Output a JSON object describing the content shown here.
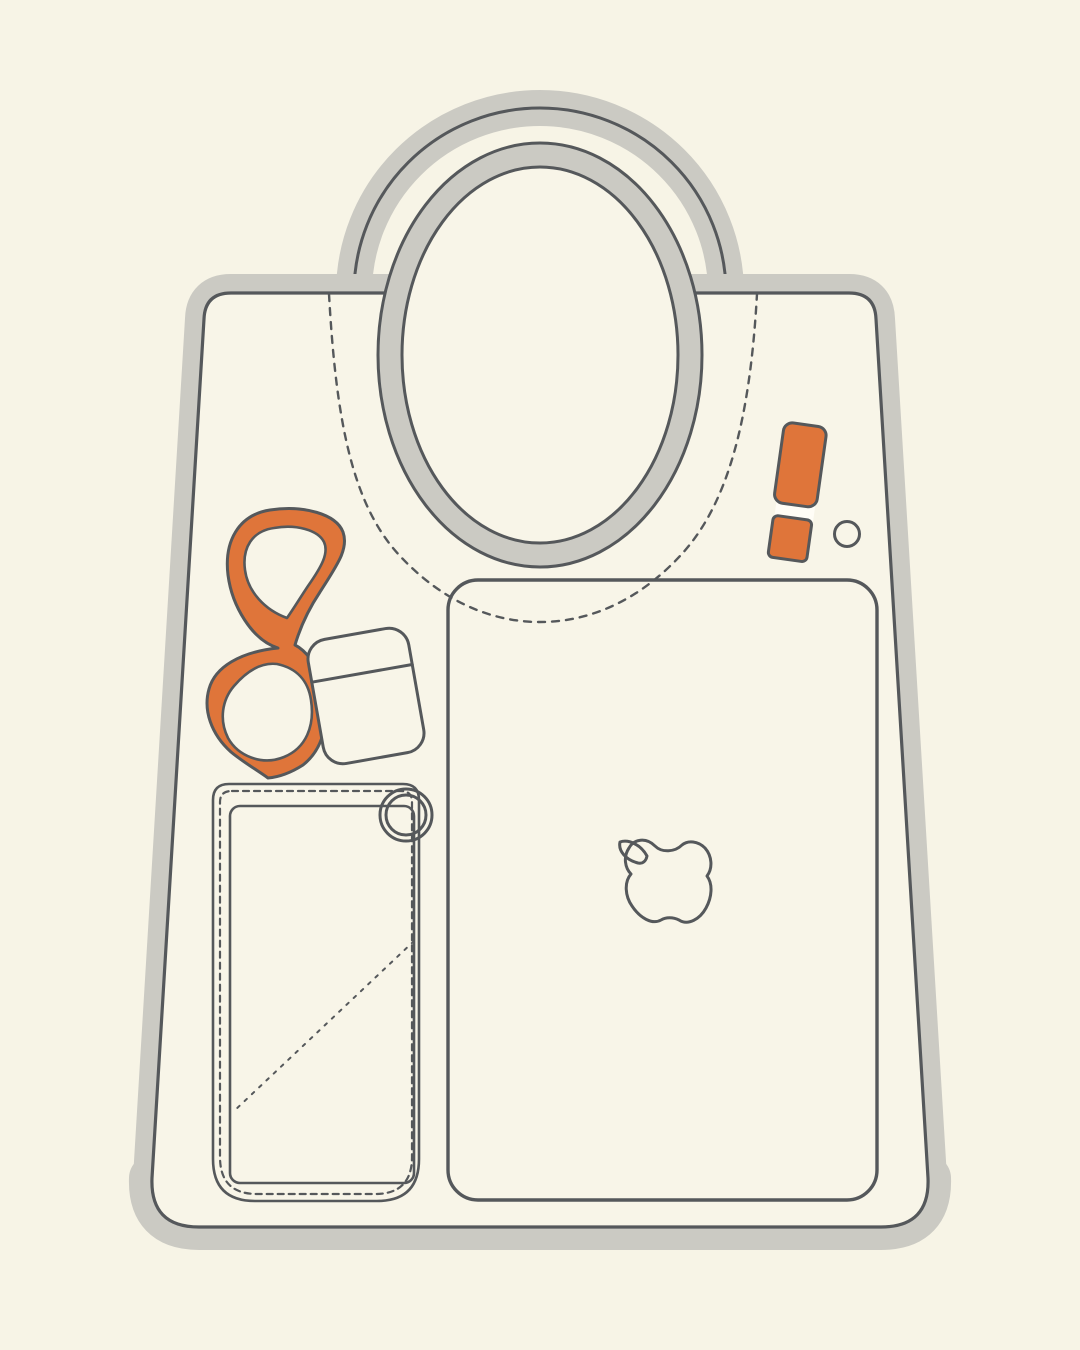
{
  "illustration": {
    "description": "Flat line illustration of a cream tote bag viewed from the front, showing its contents: folded orange glasses, a wireless earbuds case, an orange lipstick, a snap button, a stitched interior phone pocket with a zipper pull ring, and a laptop with an outlined Apple logo. The bag has an oval cut-out handle and a thick warm-grey sticker outline.",
    "colors": {
      "background": "#f7f4e6",
      "bag_fill": "#f8f5e8",
      "outline_grey": "#cbcac3",
      "line_dark": "#55585b",
      "accent_orange": "#df753a",
      "highlight_white": "#fffdf6"
    },
    "items": [
      {
        "id": "tote-bag",
        "label": "Tote bag body"
      },
      {
        "id": "handle-arch",
        "label": "Handle arch"
      },
      {
        "id": "handle-ring",
        "label": "Oval handle cut-out"
      },
      {
        "id": "stitch-line",
        "label": "Dashed stitch line under handle"
      },
      {
        "id": "glasses",
        "label": "Folded orange glasses"
      },
      {
        "id": "earbuds-case",
        "label": "Wireless earbuds case"
      },
      {
        "id": "lipstick",
        "label": "Orange lipstick"
      },
      {
        "id": "snap-button",
        "label": "Snap button"
      },
      {
        "id": "phone-pocket",
        "label": "Interior phone pocket with stitching"
      },
      {
        "id": "zipper-ring",
        "label": "Zipper pull ring"
      },
      {
        "id": "laptop",
        "label": "Laptop"
      },
      {
        "id": "apple-logo",
        "label": "Apple logo outline"
      }
    ]
  }
}
